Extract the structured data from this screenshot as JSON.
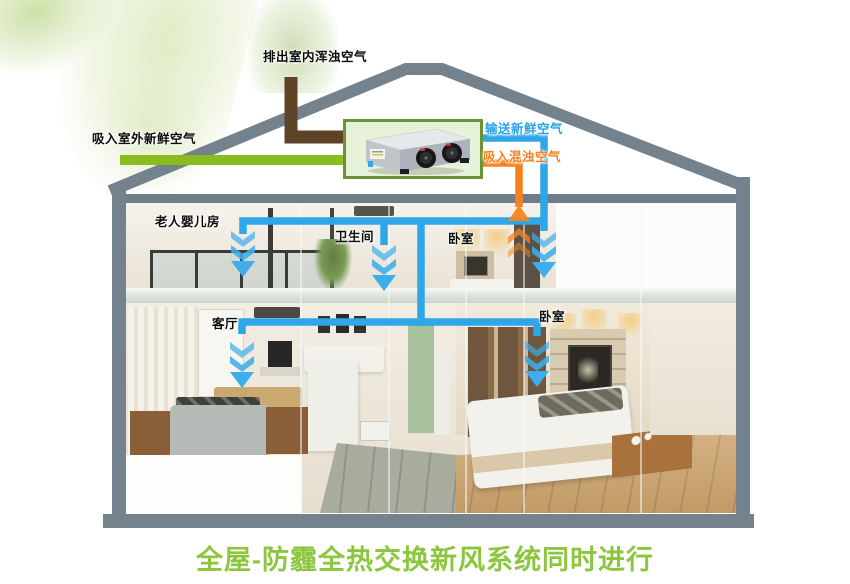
{
  "diagram": {
    "title": "全屋-防霾全热交换新风系统同时进行",
    "labels": {
      "exhaust_outdoor": "排出室内浑浊空气",
      "intake_outdoor": "吸入室外新鲜空气",
      "supply_fresh": "输送新鲜空气",
      "return_stale": "吸入混浊空气"
    },
    "rooms": {
      "elder_baby_room": "老人婴儿房",
      "bathroom": "卫生间",
      "bedroom_upper": "卧室",
      "living_room": "客厅",
      "bedroom_lower": "卧室"
    },
    "colors": {
      "fresh_air_blue": "#2EA6E8",
      "stale_air_orange": "#F5821F",
      "intake_green": "#8ABB1F",
      "exhaust_brown": "#5E4326",
      "house_gray": "#73828C",
      "title_green": "#8CC63F",
      "unit_box_fill": "#E7F3D8",
      "unit_box_border": "#6A9431"
    }
  }
}
